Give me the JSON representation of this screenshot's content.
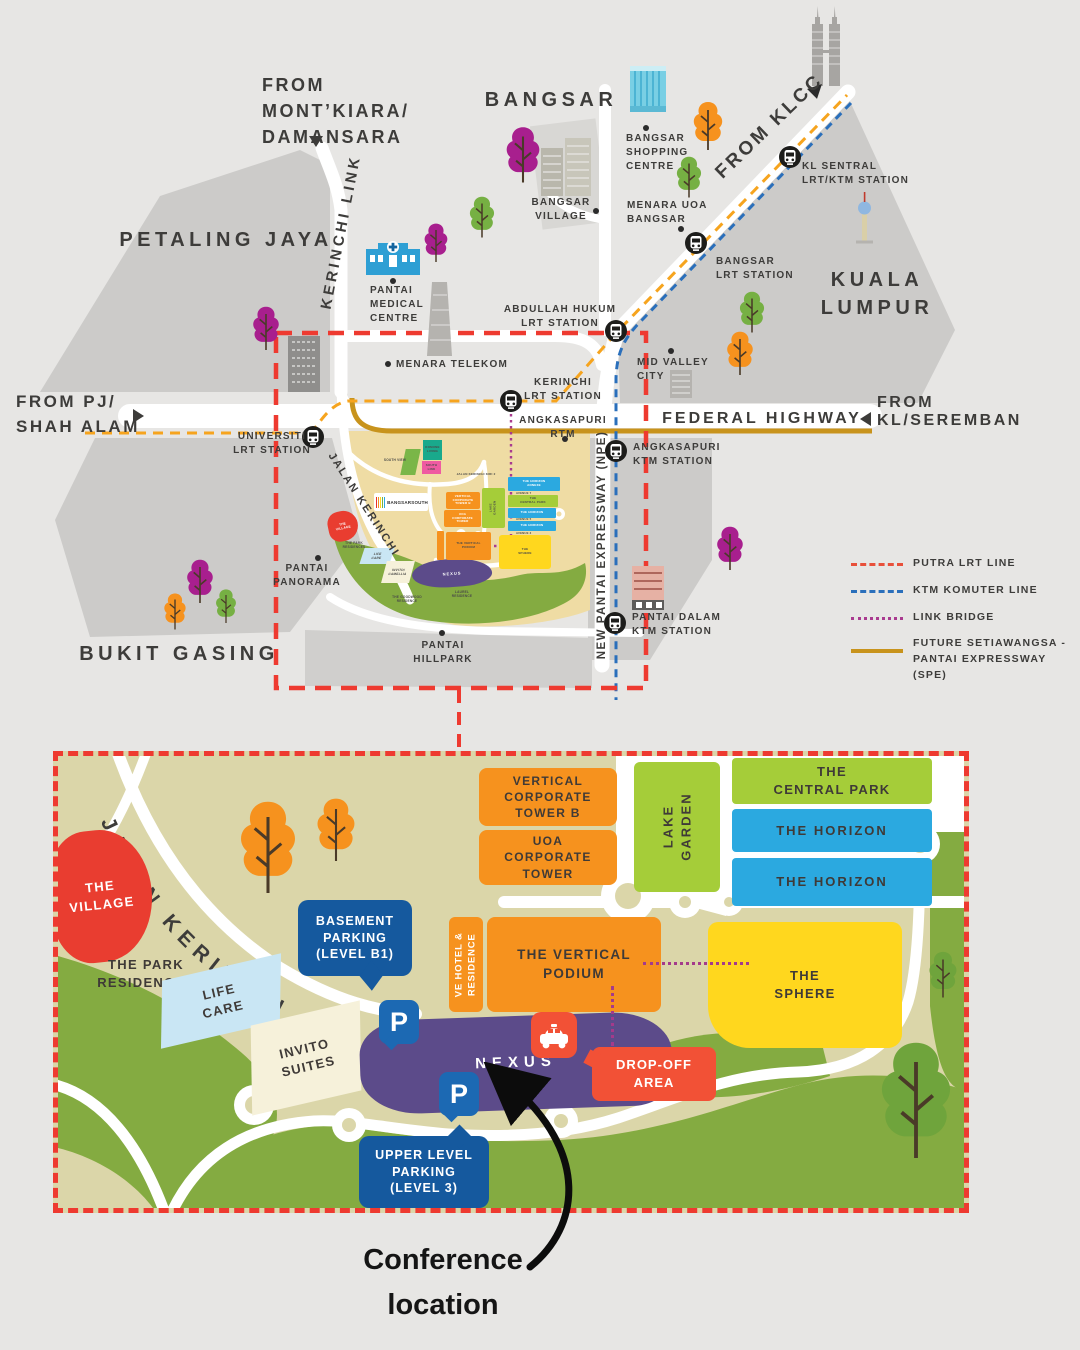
{
  "colors": {
    "map_bg": "#e7e6e4",
    "city_block": "#cccbc9",
    "dev_tan": "#efdca4",
    "detail_tan": "#dbd6a9",
    "green": "#84ab41",
    "lime": "#a5cd39",
    "horizon_blue": "#2ba9e0",
    "sphere_yellow": "#ffd71e",
    "orange": "#f6921e",
    "nexus_purple": "#5c4b8a",
    "village_red": "#e93d30",
    "callout_blue": "#15599e",
    "dropoff_red": "#f25136",
    "lrt_orange": "#f6a41e",
    "ktm_blue": "#2a6fbb",
    "link_purple": "#a93a8f",
    "spe_gold": "#c8931c",
    "frame_red": "#ee3a30"
  },
  "top_map": {
    "areas": {
      "petaling_jaya": "PETALING JAYA",
      "bangsar": "BANGSAR",
      "kuala_lumpur": "KUALA LUMPUR",
      "bukit_gasing": "BUKIT GASING",
      "mid_valley": "MID VALLEY\nCITY",
      "pantai_panorama": "PANTAI\nPANORAMA",
      "pantai_hillpark": "PANTAI\nHILLPARK"
    },
    "directions": {
      "mont_kiara": "FROM\nMONT’KIARA/\nDAMANSARA",
      "klcc": "FROM KLCC",
      "pj_shah_alam": "FROM PJ/\nSHAH ALAM",
      "from_word": "FROM",
      "kl_seremban": "KL/SEREMBAN"
    },
    "roads": {
      "kerinchi_link": "KERINCHI LINK",
      "federal_highway": "FEDERAL HIGHWAY",
      "npe": "NEW PANTAI EXPRESSWAY (NPE)",
      "jalan_kerinchi": "JALAN KERINCHI"
    },
    "stations": {
      "universiti": "UNIVERSITI\nLRT STATION",
      "kerinchi": "KERINCHI\nLRT STATION",
      "abdullah_hukum": "ABDULLAH HUKUM\nLRT STATION",
      "bangsar": "BANGSAR\nLRT STATION",
      "kl_sentral": "KL SENTRAL\nLRT/KTM STATION",
      "angkasapuri": "ANGKASAPURI\nKTM STATION",
      "pantai_dalam": "PANTAI DALAM\nKTM STATION"
    },
    "pois": {
      "pantai_medical": "PANTAI\nMEDICAL\nCENTRE",
      "menara_telekom": "MENARA TELEKOM",
      "bangsar_shopping": "BANGSAR\nSHOPPING\nCENTRE",
      "bangsar_village": "BANGSAR\nVILLAGE",
      "menara_uoa": "MENARA UOA\nBANGSAR",
      "angkasapuri_rtm": "ANGKASAPURI\nRTM"
    },
    "development": {
      "logo": "BANGSARSOUTH",
      "village": "THE\nVILLAGE",
      "park_residences": "THE PARK\nRESIDENCES",
      "life_care": "LIFE\nCARE",
      "invito": "INVITO/\nCAMELLIA",
      "nexus": "NEXUS",
      "goodwood": "THE GOODWOOD\nRESIDENCE",
      "laurel": "LAUREL\nRESIDENCE",
      "south_view": "SOUTH VIEW",
      "komune": "KOMUNE\nLIVING",
      "south_link": "SOUTH LINK",
      "kiri": "JALAN KERINCHI KIRI 2",
      "vct_b": "VERTICAL\nCORPORATE\nTOWER B",
      "uoa": "UOA\nCORPORATE\nTOWER",
      "lake_garden": "LAKE\nGARDEN",
      "central_park": "THE\nCENTRAL PARK",
      "horizon_annexe": "THE HORIZON\nANNEXE",
      "horizon_1": "THE HORIZON",
      "horizon_2": "THE HORIZON",
      "avenue_1": "AVENUE 7",
      "avenue_2": "AVENUE 5",
      "avenue_3": "AVENUE 3",
      "podium": "THE VERTICAL\nPODIUM",
      "sphere": "THE\nSPHERE"
    }
  },
  "legend": {
    "putra": "PUTRA LRT LINE",
    "ktm": "KTM KOMUTER LINE",
    "link_bridge": "LINK BRIDGE",
    "spe": "FUTURE SETIAWANGSA -\nPANTAI EXPRESSWAY (SPE)"
  },
  "detail_map": {
    "road": "JALAN KERINCHI",
    "village": "THE\nVILLAGE",
    "park_residences": "THE PARK\nRESIDENCES",
    "life_care": "LIFE\nCARE",
    "invito": "INVITO\nSUITES",
    "basement": "BASEMENT\nPARKING\n(LEVEL B1)",
    "upper": "UPPER LEVEL\nPARKING\n(LEVEL 3)",
    "parking_p": "P",
    "vct_b": "VERTICAL\nCORPORATE\nTOWER B",
    "uoa": "UOA\nCORPORATE\nTOWER",
    "lake_garden": "LAKE\nGARDEN",
    "central_park": "THE\nCENTRAL PARK",
    "horizon_1": "THE HORIZON",
    "horizon_2": "THE HORIZON",
    "ve_hotel": "VE HOTEL &\nRESIDENCE",
    "podium": "THE VERTICAL\nPODIUM",
    "sphere": "THE\nSPHERE",
    "nexus": "NEXUS",
    "dropoff": "DROP-OFF\nAREA"
  },
  "footer": {
    "note": "Conference\nlocation"
  }
}
